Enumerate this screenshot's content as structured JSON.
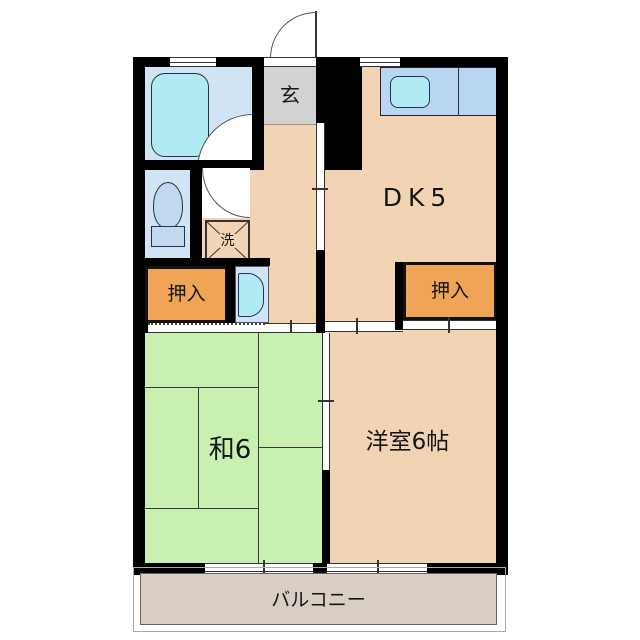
{
  "floorplan": {
    "type": "apartment-floor-plan-2DK",
    "rooms": {
      "genkan": {
        "label": "玄"
      },
      "dk": {
        "label": "DK5"
      },
      "closet_left": {
        "label": "押入"
      },
      "closet_right": {
        "label": "押入"
      },
      "laundry": {
        "label": "洗"
      },
      "japanese_room": {
        "label": "和6"
      },
      "western_room": {
        "label": "洋室6帖"
      },
      "balcony": {
        "label": "バルコニー"
      }
    },
    "colors": {
      "wall": "#000000",
      "floor_peach": "#f2d4b4",
      "closet_orange": "#f0a456",
      "tatami_green": "#c8f0b0",
      "wet_area_blue": "#d0e4f6",
      "fixture_cyan": "#b0eaf2",
      "kitchen_counter_blue": "#b8d6f2",
      "genkan_gray": "#d2d2d2",
      "balcony_gray": "#d8cec3",
      "background": "#ffffff"
    }
  }
}
